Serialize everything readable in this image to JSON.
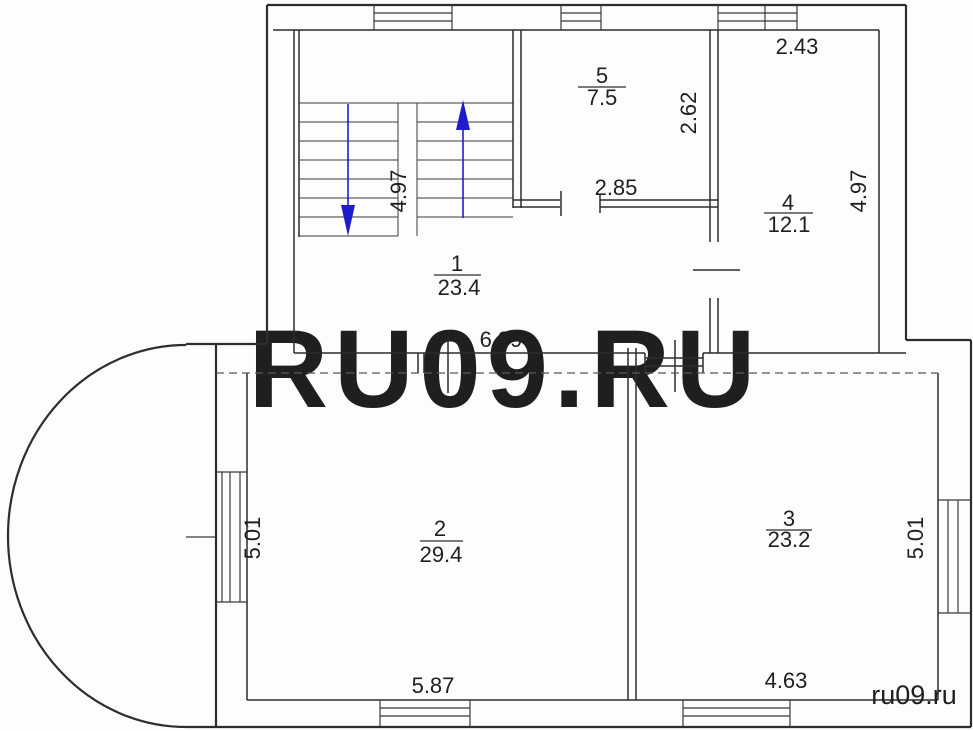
{
  "rooms": [
    {
      "number": "1",
      "area": "23.4"
    },
    {
      "number": "2",
      "area": "29.4"
    },
    {
      "number": "3",
      "area": "23.2"
    },
    {
      "number": "4",
      "area": "12.1"
    },
    {
      "number": "5",
      "area": "7.5"
    }
  ],
  "dimensions": {
    "top_right_width": "2.43",
    "room4_left_height": "2.62",
    "room5_door_width": "2.85",
    "stairwell_height": "4.97",
    "room4_right_height": "4.97",
    "hall_bottom_width": "6.39",
    "room2_left_height": "5.01",
    "room3_right_height": "5.01",
    "room2_bottom_width": "5.87",
    "room3_bottom_width": "4.63"
  },
  "stairs": {
    "up_arrow_icon": "stairs-up-arrow",
    "down_arrow_icon": "stairs-down-arrow"
  },
  "watermark": {
    "large": "RU09.RU",
    "small": "ru09.ru",
    "large_color": "#eaeaea",
    "small_color": "#8a8a8a"
  },
  "colors": {
    "wall": "#2d2d2d",
    "thin_line": "#3a3a3a",
    "dashed_line": "#5a5a5a",
    "arrow": "#1d1dcb",
    "background": "#fdfdfd"
  }
}
